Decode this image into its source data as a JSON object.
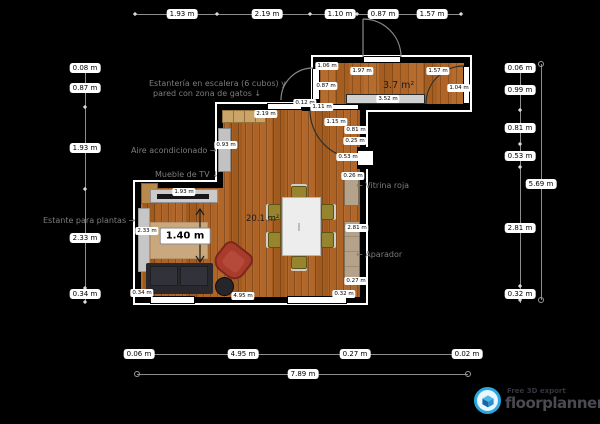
{
  "areas": {
    "living": "20.1 m²",
    "hall": "3.7 m²"
  },
  "dims_top": [
    "1.93 m",
    "2.19 m",
    "1.10 m",
    "0.87 m",
    "1.57 m"
  ],
  "dims_left": [
    "0.08 m",
    "0.87 m",
    "1.93 m",
    "2.33 m",
    "0.34 m"
  ],
  "dims_right": [
    "0.06 m",
    "0.99 m",
    "0.81 m",
    "0.53 m",
    "2.81 m",
    "0.32 m"
  ],
  "dim_right_total": "5.69 m",
  "dims_bottom": [
    "0.06 m",
    "4.95 m",
    "0.27 m",
    "0.02 m"
  ],
  "dim_bottom_total": "7.89 m",
  "interior": {
    "shelf_top": "2.19 m",
    "wall_stub": "0.12 m",
    "wall_seg": "1.11 m",
    "door_main": "1.15 m",
    "seg_081": "0.81 m",
    "seg_025": "0.25 m",
    "door_side": "0.53 m",
    "vitrina_depth": "0.26 m",
    "aparador_len": "2.81 m",
    "seg_027": "0.27 m",
    "corner_032": "0.32 m",
    "tv_width": "1.93 m",
    "ac_height": "0.93 m",
    "plant_shelf": "2.33 m",
    "bottom_left": "0.34 m",
    "bottom_wall": "4.95 m",
    "sofa_tv_gap": "1.40 m",
    "sr_left_top": "1.06 m",
    "sr_door_left": "0.87 m",
    "sr_top_1": "1.97 m",
    "sr_top_2": "1.57 m",
    "sr_right": "1.04 m",
    "sr_counter": "3.52 m"
  },
  "annotations": {
    "shelving_line1": "Estantería en escalera (6 cubos) y",
    "shelving_line2": "pared con zona de gatos ↓",
    "ac": "Aire acondicionado →",
    "tv": "Mueble de TV ↓",
    "plants": "Estante para plantas →",
    "vitrina": "← Vitrina roja",
    "aparador": "← Aparador"
  },
  "watermark": {
    "tagline": "Free 3D export",
    "name": "floorplanner"
  },
  "colors": {
    "background": "#000000",
    "wood_floor": "#ab6125",
    "wall": "#000000",
    "wall_halo": "#ffffff",
    "brand_blue": "#29a8e0",
    "annotation_gray": "#7d7d7d",
    "furniture_gray": "#c9c9c9",
    "armchair_red": "#a83b2b",
    "cabinet_tan": "#b4a28b"
  }
}
